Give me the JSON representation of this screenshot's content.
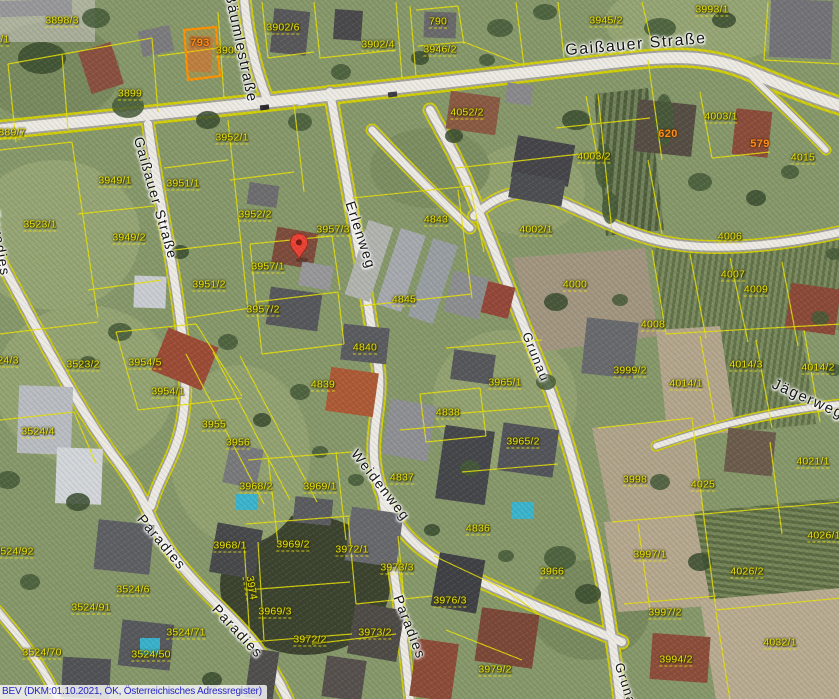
{
  "map": {
    "attribution": "BEV (DKM:01.10.2021, ÖK, Österreichisches Adressregister)",
    "marker": {
      "x": 299,
      "y": 259,
      "color": "#ea4335"
    },
    "colors": {
      "parcel_line": "#e8e008",
      "parcel_label": "#e8e008",
      "address_label": "#ff8d1a",
      "street_label": "#141414",
      "attribution_text": "#2424c8",
      "highlight_parcel": "#ff9000"
    },
    "streets": [
      {
        "label": "Gaißauer Straße",
        "x": 636,
        "y": 45,
        "rot": -5,
        "size": 16
      },
      {
        "label": "Gaißauer Straße",
        "x": 156,
        "y": 198,
        "rot": 74,
        "size": 14
      },
      {
        "label": "Bäumlestraße",
        "x": 241,
        "y": 48,
        "rot": 78,
        "size": 15
      },
      {
        "label": "Erlenweg",
        "x": 361,
        "y": 235,
        "rot": 72,
        "size": 14
      },
      {
        "label": "Weidenweg",
        "x": 381,
        "y": 485,
        "rot": 52,
        "size": 14
      },
      {
        "label": "Grunau",
        "x": 536,
        "y": 357,
        "rot": 68,
        "size": 13
      },
      {
        "label": "Grunau",
        "x": 627,
        "y": 688,
        "rot": 72,
        "size": 13
      },
      {
        "label": "Paradies",
        "x": 0,
        "y": 243,
        "rot": 80,
        "size": 14
      },
      {
        "label": "Paradies",
        "x": 162,
        "y": 542,
        "rot": 50,
        "size": 14
      },
      {
        "label": "Paradies",
        "x": 238,
        "y": 631,
        "rot": 47,
        "size": 14
      },
      {
        "label": "Paradies",
        "x": 410,
        "y": 627,
        "rot": 69,
        "size": 14
      },
      {
        "label": "Jägerweg",
        "x": 808,
        "y": 399,
        "rot": 24,
        "size": 15
      }
    ],
    "addresses": [
      {
        "label": "793",
        "x": 200,
        "y": 43
      },
      {
        "label": "620",
        "x": 668,
        "y": 134
      },
      {
        "label": "579",
        "x": 760,
        "y": 144
      }
    ],
    "parcels": [
      {
        "label": "3898/3",
        "x": 62,
        "y": 21
      },
      {
        "label": "/1",
        "x": 5,
        "y": 40
      },
      {
        "label": "3899",
        "x": 130,
        "y": 94
      },
      {
        "label": "889/7",
        "x": 12,
        "y": 133
      },
      {
        "label": "3900",
        "x": 228,
        "y": 51
      },
      {
        "label": "3902/6",
        "x": 283,
        "y": 28
      },
      {
        "label": "3902/4",
        "x": 378,
        "y": 45
      },
      {
        "label": "3946/2",
        "x": 440,
        "y": 50
      },
      {
        "label": "790",
        "x": 438,
        "y": 22
      },
      {
        "label": "3945/2",
        "x": 606,
        "y": 21
      },
      {
        "label": "3993/1",
        "x": 712,
        "y": 10
      },
      {
        "label": "4052/2",
        "x": 467,
        "y": 113
      },
      {
        "label": "4003/2",
        "x": 594,
        "y": 157
      },
      {
        "label": "4003/1",
        "x": 721,
        "y": 117
      },
      {
        "label": "4015",
        "x": 803,
        "y": 158
      },
      {
        "label": "4002/1",
        "x": 536,
        "y": 230
      },
      {
        "label": "4843",
        "x": 436,
        "y": 220
      },
      {
        "label": "3957/3",
        "x": 333,
        "y": 230
      },
      {
        "label": "3952/1",
        "x": 232,
        "y": 138
      },
      {
        "label": "3949/1",
        "x": 115,
        "y": 181
      },
      {
        "label": "3951/1",
        "x": 183,
        "y": 184
      },
      {
        "label": "3523/1",
        "x": 40,
        "y": 225
      },
      {
        "label": "3949/2",
        "x": 129,
        "y": 238
      },
      {
        "label": "3952/2",
        "x": 255,
        "y": 215
      },
      {
        "label": "3951/2",
        "x": 209,
        "y": 285
      },
      {
        "label": "3957/1",
        "x": 268,
        "y": 267
      },
      {
        "label": "3957/2",
        "x": 263,
        "y": 310
      },
      {
        "label": "4845",
        "x": 404,
        "y": 300
      },
      {
        "label": "4840",
        "x": 365,
        "y": 348
      },
      {
        "label": "4839",
        "x": 323,
        "y": 385
      },
      {
        "label": "4838",
        "x": 448,
        "y": 413
      },
      {
        "label": "4837",
        "x": 402,
        "y": 478
      },
      {
        "label": "3965/1",
        "x": 505,
        "y": 383
      },
      {
        "label": "3965/2",
        "x": 523,
        "y": 442
      },
      {
        "label": "4000",
        "x": 575,
        "y": 285
      },
      {
        "label": "4006",
        "x": 730,
        "y": 237
      },
      {
        "label": "4007",
        "x": 733,
        "y": 275
      },
      {
        "label": "4009",
        "x": 756,
        "y": 290
      },
      {
        "label": "4008",
        "x": 653,
        "y": 325
      },
      {
        "label": "4014/3",
        "x": 746,
        "y": 365
      },
      {
        "label": "4014/2",
        "x": 818,
        "y": 368
      },
      {
        "label": "4014/1",
        "x": 686,
        "y": 384
      },
      {
        "label": "3999/2",
        "x": 630,
        "y": 371
      },
      {
        "label": "3998",
        "x": 635,
        "y": 480
      },
      {
        "label": "4025",
        "x": 703,
        "y": 485
      },
      {
        "label": "4021/1",
        "x": 813,
        "y": 462
      },
      {
        "label": "4026/1",
        "x": 824,
        "y": 536
      },
      {
        "label": "4026/2",
        "x": 747,
        "y": 572
      },
      {
        "label": "3997/1",
        "x": 650,
        "y": 555
      },
      {
        "label": "3997/2",
        "x": 665,
        "y": 613
      },
      {
        "label": "4032/1",
        "x": 780,
        "y": 643
      },
      {
        "label": "3994/2",
        "x": 676,
        "y": 660
      },
      {
        "label": "3966",
        "x": 552,
        "y": 572
      },
      {
        "label": "4836",
        "x": 478,
        "y": 529
      },
      {
        "label": "3979/2",
        "x": 495,
        "y": 670
      },
      {
        "label": "3976/3",
        "x": 450,
        "y": 601
      },
      {
        "label": "3973/3",
        "x": 397,
        "y": 568
      },
      {
        "label": "3973/2",
        "x": 375,
        "y": 633
      },
      {
        "label": "3972/1",
        "x": 352,
        "y": 550
      },
      {
        "label": "3972/2",
        "x": 310,
        "y": 640
      },
      {
        "label": "3969/2",
        "x": 293,
        "y": 545
      },
      {
        "label": "3969/3",
        "x": 275,
        "y": 612
      },
      {
        "label": "3969/1",
        "x": 320,
        "y": 487
      },
      {
        "label": "3968/2",
        "x": 256,
        "y": 487
      },
      {
        "label": "3968/1",
        "x": 230,
        "y": 546
      },
      {
        "label": "3523/2",
        "x": 83,
        "y": 365
      },
      {
        "label": "3954/5",
        "x": 145,
        "y": 363
      },
      {
        "label": "3954/1",
        "x": 168,
        "y": 392
      },
      {
        "label": "3524/4",
        "x": 38,
        "y": 432
      },
      {
        "label": "24/3",
        "x": 8,
        "y": 361
      },
      {
        "label": "3955",
        "x": 214,
        "y": 425
      },
      {
        "label": "3956",
        "x": 238,
        "y": 443
      },
      {
        "label": "3524/92",
        "x": 14,
        "y": 552
      },
      {
        "label": "3524/6",
        "x": 133,
        "y": 590
      },
      {
        "label": "3524/91",
        "x": 91,
        "y": 608
      },
      {
        "label": "3524/71",
        "x": 186,
        "y": 633
      },
      {
        "label": "3524/50",
        "x": 151,
        "y": 655
      },
      {
        "label": "3524/70",
        "x": 42,
        "y": 653
      },
      {
        "label": "3974",
        "x": 251,
        "y": 588,
        "rot": 80
      }
    ]
  }
}
